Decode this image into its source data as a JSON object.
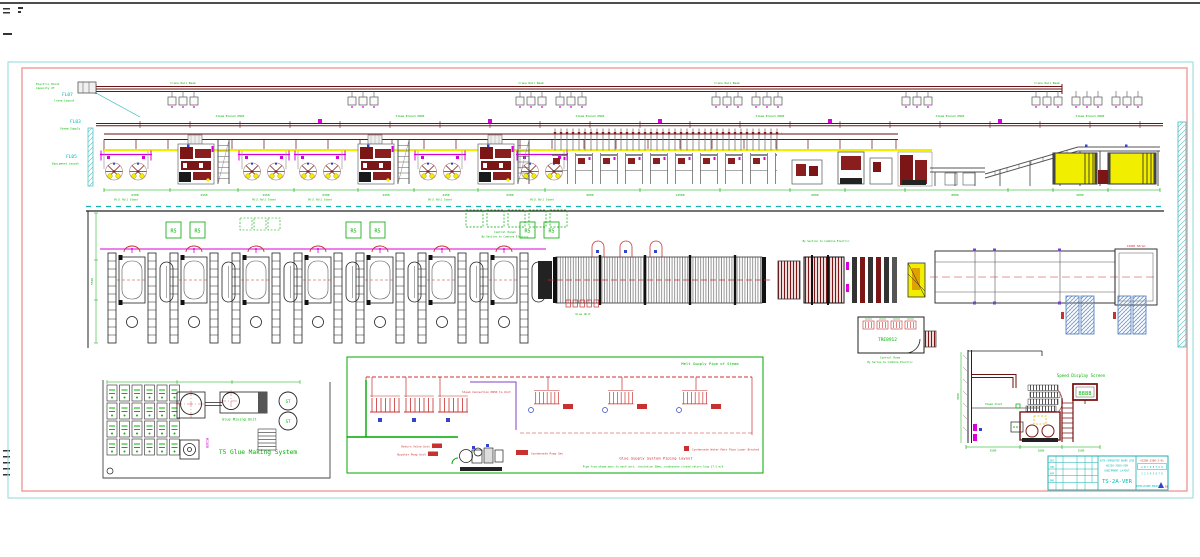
{
  "colors": {
    "frame_outer": "#8fd8d8",
    "frame_inner": "#f2a0a0",
    "maroon": "#7c1616",
    "magenta": "#d800d8",
    "cad_green": "#00b400",
    "cad_cyan": "#00b7b7",
    "yellow": "#f2ee00",
    "pallet_blue": "#5b87c9",
    "red": "#d03030"
  },
  "margin_labels": {
    "fl07": "FL07",
    "fl07_note": "Crane Layout",
    "fl03": "FL03",
    "fl03_note": "Steam Supply",
    "fl05": "FL05",
    "fl05_note": "Equipment Layout",
    "hoist_note": "Electric Hoist",
    "hoist_note2": "Capacity 2T",
    "crane_note": "Crane Rail Beam",
    "steam_note": "Steam Branch DN40"
  },
  "top_band": {
    "dims": [
      "6300",
      "2450",
      "2450",
      "6300",
      "2450",
      "2450",
      "6300",
      "9000",
      "14500",
      "6000",
      "8000",
      "5000"
    ],
    "station_note": "Mill Roll Stand"
  },
  "mid_band": {
    "stand_label": "RS",
    "control_panel": "Control Panel",
    "control_panel_sub": "By Section to Combine Electric",
    "df_note": "Glue Unit",
    "speed_note": "14000 50rpm",
    "vdim": "5500",
    "control_room": {
      "code": "TRE8912",
      "note1": "Control Room",
      "note2": "By Series to Combine Electric"
    }
  },
  "glue": {
    "title": "T5 Glue Making System",
    "area_label": "Glue Mixing Unit",
    "mixer_label": "MIXER",
    "tank_label": "ST"
  },
  "piping": {
    "header": "Melt Supply Pipe of Steam",
    "title_red": "Glue Supply System Piping Layout",
    "title_green": "Pipe from steam main to each unit, insulation 30mm, condensate closed return loop 17.5 m/h",
    "tag_steam": "Steam Connection DN50 to Unit",
    "tag_return1": "Return Valve Unit",
    "tag_return2": "Booster Pump Unit",
    "tag_pump": "Condensate Pump Set",
    "tag_condensate": "Condensate Water Main Pipe Lower Bracket"
  },
  "speed": {
    "screen_label": "Speed Display Screen",
    "screen_value": "8888",
    "pipe_note": "Steam Inlet",
    "dims": [
      "2500",
      "1800",
      "1500"
    ],
    "vdim": "3500"
  },
  "titleblock": {
    "cells": [
      "DES",
      "CHK",
      "APP",
      "PRO"
    ],
    "l1": "AUTO CORRUGATED BOARD LINE",
    "l2": "WJ250-2500-V5B",
    "l3": "EQUIPMENT LAYOUT",
    "big": "TS-2A-VER",
    "r1": "A2200-2306-2-01",
    "r2": "A B C D E F G H",
    "r3": "1 2 3 4 5 6 7 8",
    "r4": "INTELLIGENT EQUIP CO.",
    "logo": "DL"
  }
}
